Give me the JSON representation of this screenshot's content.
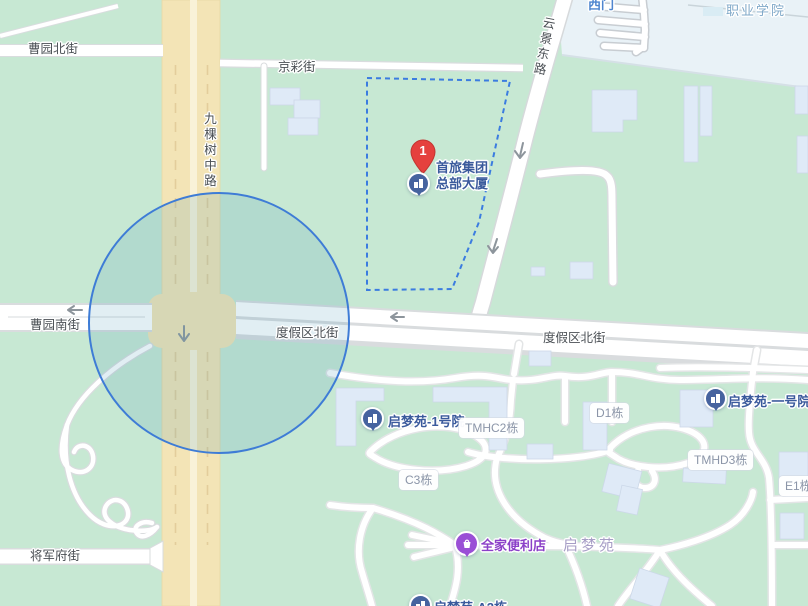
{
  "streets": {
    "caoyuan_north": "曹园北街",
    "jingcai": "京彩街",
    "jiukeshu": "九棵树中路",
    "yunjing": "云景东路",
    "caoyuan_south": "曹园南街",
    "dujiaqu_west": "度假区北街",
    "dujiaqu_east": "度假区北街",
    "jiangjunfu": "将军府街"
  },
  "areas": {
    "college": "职业学院",
    "west_gate": "西门",
    "qimengyuan": "启梦苑"
  },
  "marker": {
    "number": "1",
    "name_line1": "首旅集团",
    "name_line2": "总部大厦"
  },
  "pois": [
    {
      "label": "启梦苑-1号院",
      "type": "residence"
    },
    {
      "label": "启梦苑-一号院",
      "type": "residence"
    },
    {
      "label": "全家便利店",
      "type": "convenience-store"
    },
    {
      "label": "启梦苑-A2栋",
      "type": "residence"
    }
  ],
  "buildings": [
    "TMHC2栋",
    "C3栋",
    "D1栋",
    "TMHD3栋",
    "E1栋"
  ],
  "icons": {
    "marker": "red-numbered-pin",
    "residence_pin": "building-icon",
    "store_pin": "shopping-bag-icon"
  },
  "colors": {
    "marker-red": "#e5413e",
    "pin-blue": "#46639f",
    "store-purple": "#9a4fd6",
    "store-text": "#8b40c8",
    "poi-text-blue": "#3a5a9c",
    "street-text": "#4b5055",
    "chip-text": "#8b95a8",
    "campus-text": "#7fa8c8",
    "gate-text": "#4f86cf",
    "area-text": "#a79ec6",
    "circle-stroke": "#3e7cd6",
    "polygon-stroke": "#3b7ce0"
  }
}
